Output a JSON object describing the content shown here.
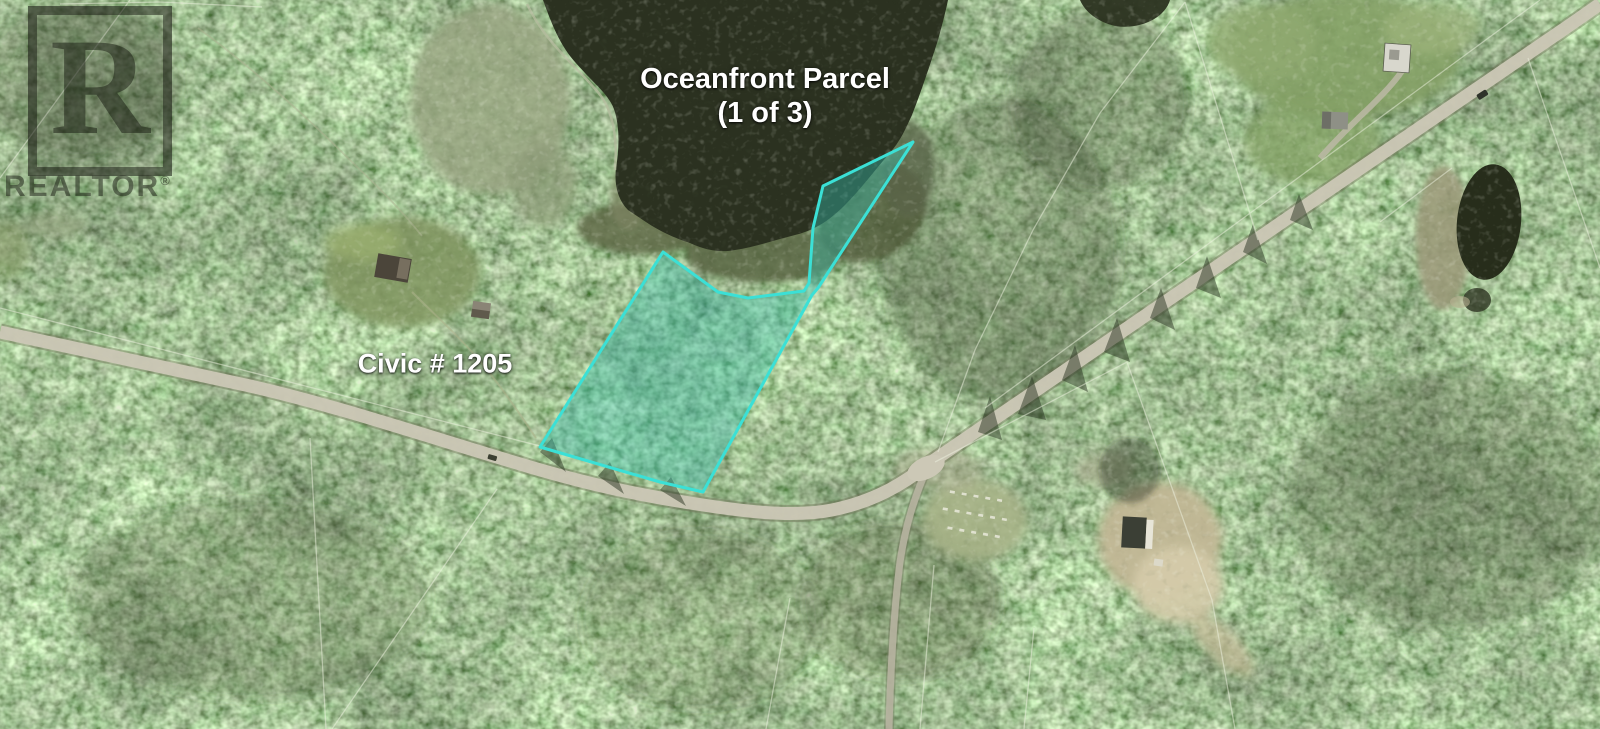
{
  "page": {
    "type": "aerial-property-listing-photo",
    "width_px": 1600,
    "height_px": 729
  },
  "annotations": {
    "parcel_title_line1": "Oceanfront Parcel",
    "parcel_title_line2": "(1 of 3)",
    "civic_label": "Civic # 1205"
  },
  "watermark": {
    "logo_letter": "R",
    "brand": "REALTOR",
    "registered_symbol": "®"
  },
  "parcel": {
    "name": "Oceanfront Parcel (1 of 3)",
    "outline_color": "#3BE0D6",
    "fill_color": "rgba(52,190,175,0.40)"
  },
  "map_features": {
    "water_body": "lake",
    "small_pond": "pond",
    "main_road": "main-road",
    "side_road": "branch-road",
    "cemetery": "cemetery-clearing",
    "cleared_lot": "gravel-pit-lot",
    "boundaries": "property-lines"
  },
  "colors": {
    "label_text": "#FFFFFF",
    "forest_base": "#5A6A4A",
    "water": "#2B3120",
    "road": "#CCC8B6",
    "watermark_tint": "rgba(25,28,20,0.50)"
  }
}
